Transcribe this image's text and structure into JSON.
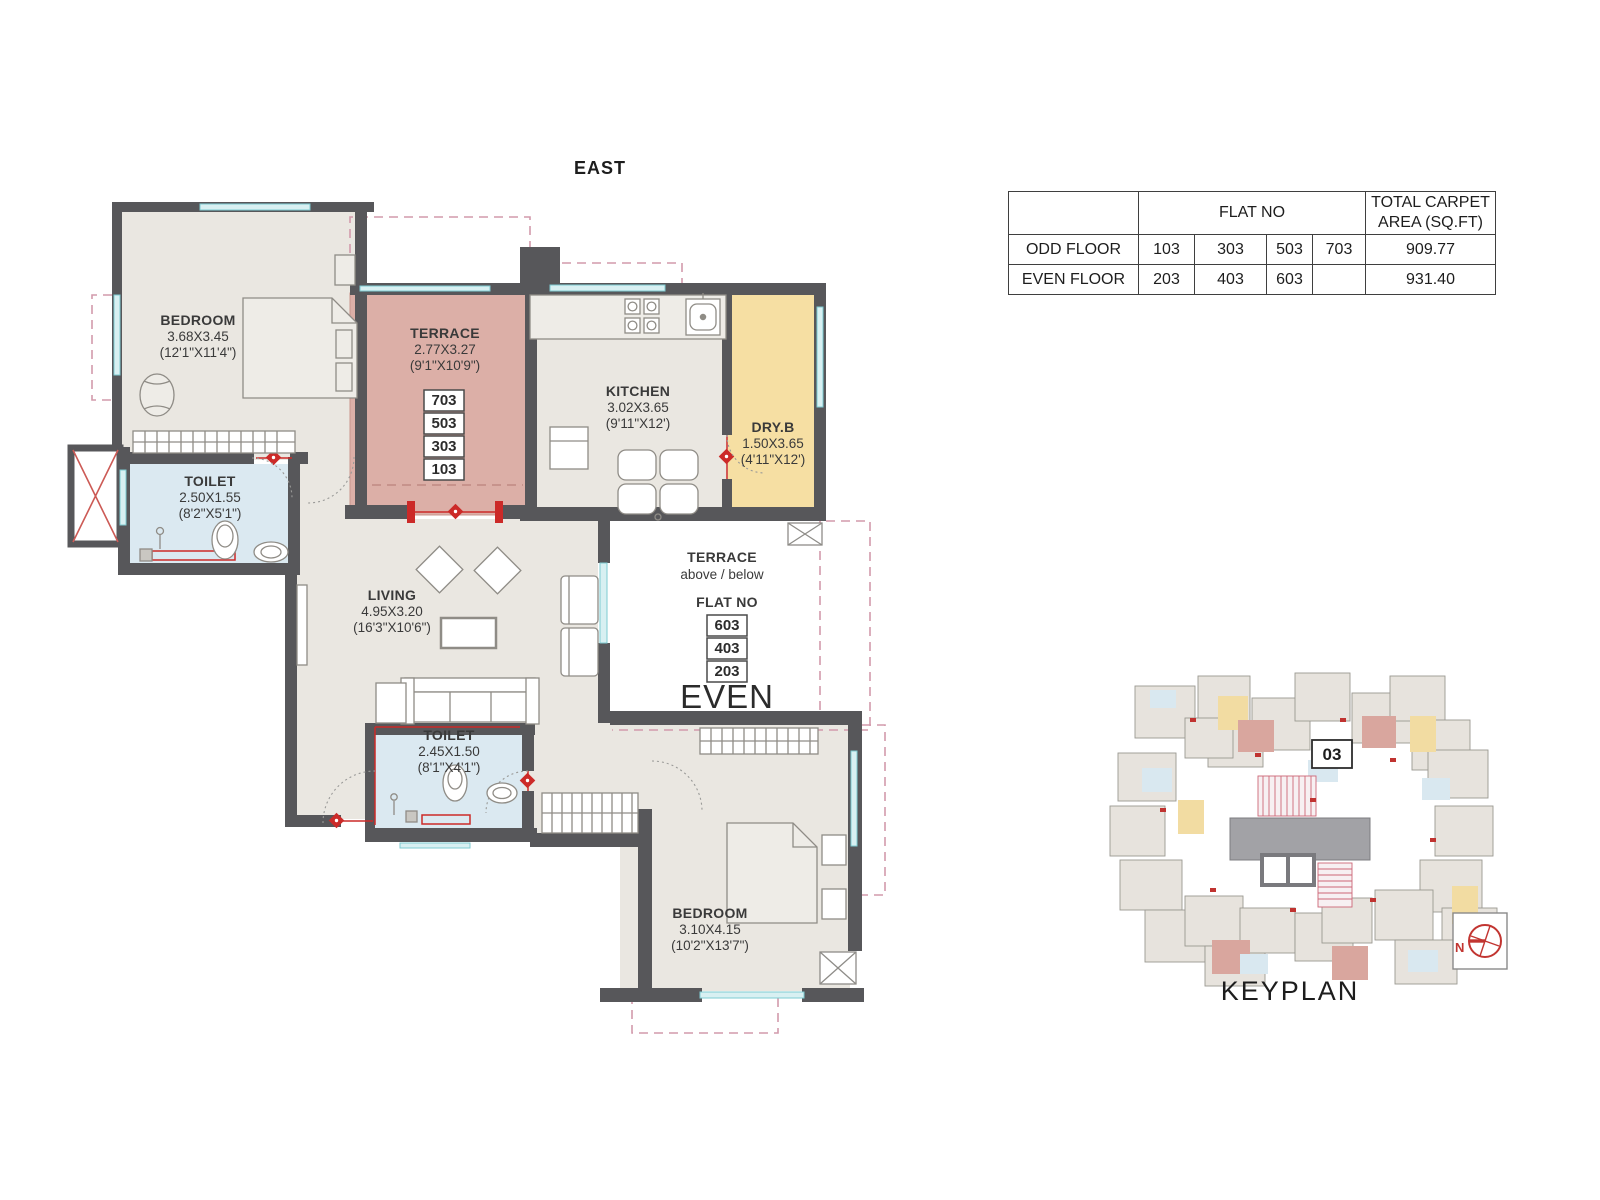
{
  "headings": {
    "east": "EAST",
    "keyplan": "KEYPLAN",
    "north": "N"
  },
  "table": {
    "flat_no_header": "FLAT NO",
    "area_header": "TOTAL CARPET AREA  (SQ.FT)",
    "rows": [
      {
        "label": "ODD FLOOR",
        "flats": [
          "103",
          "303",
          "503",
          "703"
        ],
        "area": "909.77"
      },
      {
        "label": "EVEN FLOOR",
        "flats": [
          "203",
          "403",
          "603",
          ""
        ],
        "area": "931.40"
      }
    ]
  },
  "rooms": {
    "bedroom1": {
      "name": "BEDROOM",
      "dim": "3.68X3.45",
      "dim_ft": "(12'1\"X11'4\")"
    },
    "terrace": {
      "name": "TERRACE",
      "dim": "2.77X3.27",
      "dim_ft": "(9'1\"X10'9\")",
      "flat_nos": [
        "703",
        "503",
        "303",
        "103"
      ]
    },
    "kitchen": {
      "name": "KITCHEN",
      "dim": "3.02X3.65",
      "dim_ft": "(9'11\"X12')"
    },
    "dry_balcony": {
      "name": "DRY.B",
      "dim": "1.50X3.65",
      "dim_ft": "(4'11\"X12')"
    },
    "toilet1": {
      "name": "TOILET",
      "dim": "2.50X1.55",
      "dim_ft": "(8'2\"X5'1\")"
    },
    "living": {
      "name": "LIVING",
      "dim": "4.95X3.20",
      "dim_ft": "(16'3\"X10'6\")"
    },
    "terrace_ab": {
      "name": "TERRACE",
      "sub": "above / below",
      "flat_no_label": "FLAT NO",
      "flat_nos": [
        "603",
        "403",
        "203"
      ],
      "floor_word": "EVEN"
    },
    "toilet2": {
      "name": "TOILET",
      "dim": "2.45X1.50",
      "dim_ft": "(8'1\"X4'1\")"
    },
    "bedroom2": {
      "name": "BEDROOM",
      "dim": "3.10X4.15",
      "dim_ft": "(10'2\"X13'7\")"
    }
  },
  "keyplan": {
    "unit_label": "03"
  },
  "colors": {
    "wall": "#57575a",
    "floor": "#eae7e1",
    "terrace_fill": "#dcafa7",
    "dry_balcony_fill": "#f6dfa3",
    "toilet_fill": "#dbe9f1",
    "accent_red": "#cc2a28",
    "window_cyan": "#bfe3e6",
    "dashed_pink": "#d29aac"
  }
}
